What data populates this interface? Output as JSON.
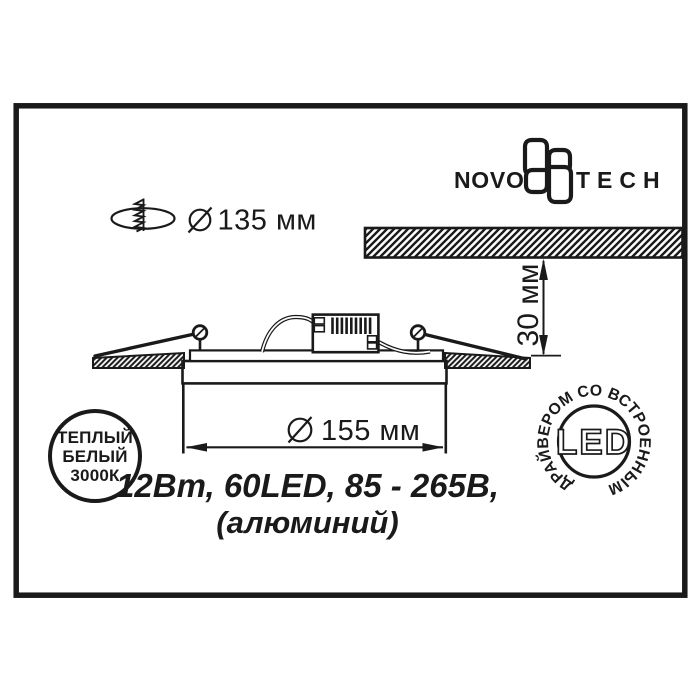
{
  "colors": {
    "ink": "#1a1a1a",
    "background": "#ffffff"
  },
  "logo": {
    "left": "NOVO",
    "right": "TECH"
  },
  "dimensions": {
    "cutout_diameter": "135 мм",
    "recess_depth": "30 мм",
    "body_diameter": "155 мм"
  },
  "specs": {
    "line1": "12Вт, 60LED, 85 - 265В,",
    "line2": "(алюминий)"
  },
  "badge_color_temp": {
    "line1": "ТЕПЛЫЙ",
    "line2": "БЕЛЫЙ",
    "line3": "3000К"
  },
  "badge_led": {
    "ring_text": "ДРАЙВЕРОМ СО ВСТРОЕННЫМ",
    "center_text": "LED"
  }
}
